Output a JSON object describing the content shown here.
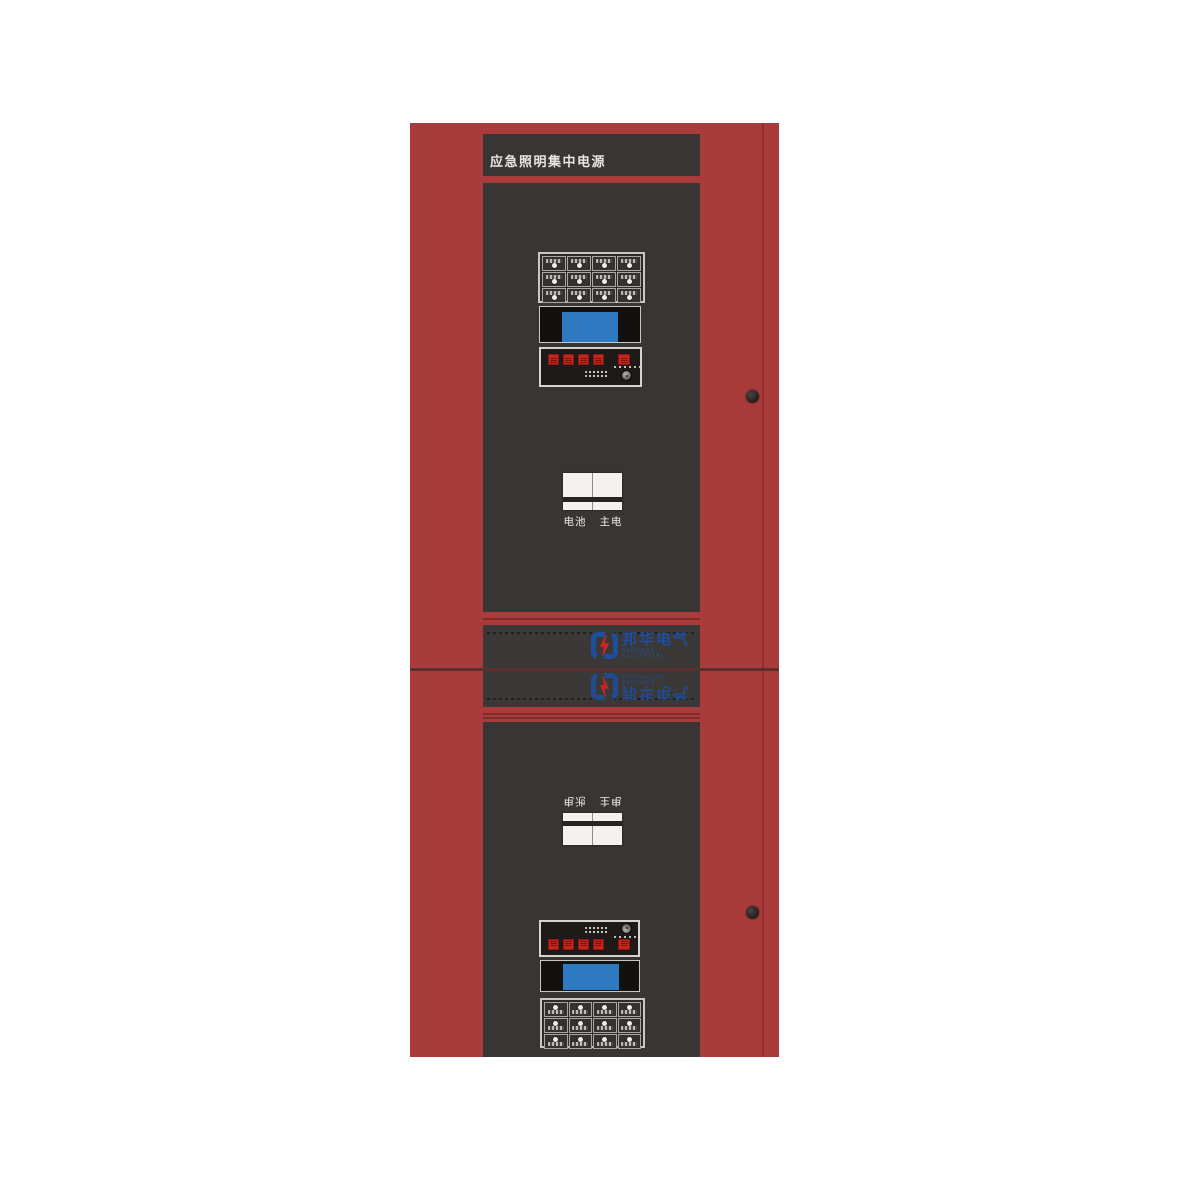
{
  "device": {
    "title": "应急照明集中电源",
    "brand": {
      "name_cn": "邦华电气",
      "name_en": "BANGHUA ELECTRICAL"
    },
    "colors": {
      "cabinet_red": "#a93b3b",
      "panel_dark": "#383534",
      "lcd_blue": "#2d7ac0",
      "led_red": "#c6271c",
      "logo_blue": "#1e4e9c",
      "bolt_red": "#d42420"
    },
    "upper_unit": {
      "keypad": {
        "rows": 3,
        "cols": 4
      },
      "indicators": {
        "led_count_left": 4,
        "led_count_right": 1
      },
      "switch_label": "电池 主电"
    },
    "lower_unit": {
      "keypad": {
        "rows": 3,
        "cols": 4
      },
      "indicators": {
        "led_count_left": 4,
        "led_count_right": 1
      },
      "switch_label": "电池 主电"
    }
  }
}
